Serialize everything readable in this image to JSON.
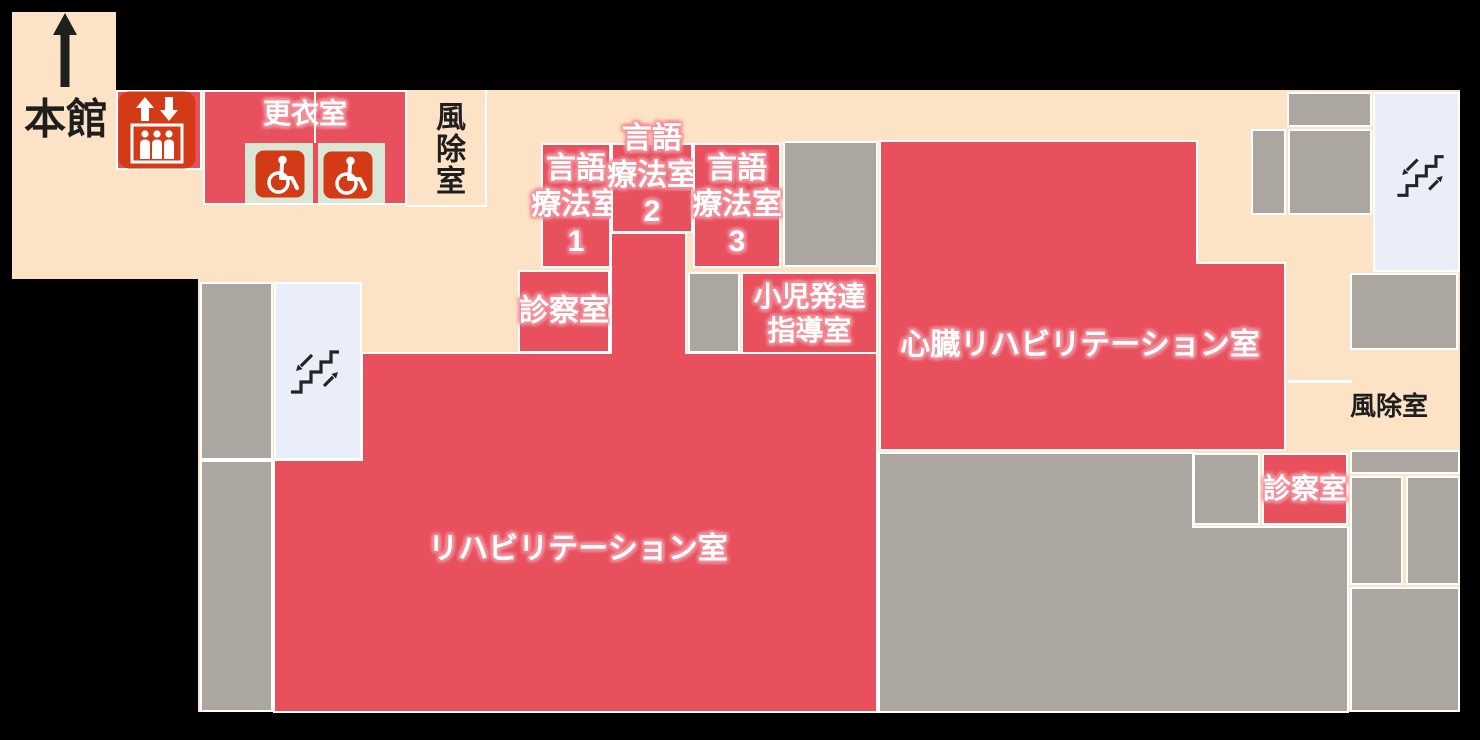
{
  "canvas": {
    "width": 1480,
    "height": 740,
    "background": "#000000"
  },
  "palette": {
    "floor_cream": "#FCE3C5",
    "room_red": "#E8505E",
    "room_gray": "#ABA69F",
    "stair_blue": "#E9EEF8",
    "pad_green": "#D9E7D4",
    "icon_red": "#D23B16",
    "wall_line": "#FFFFFF",
    "text_dark": "#1E1E1E",
    "text_light": "#FFFFFF",
    "label_halo": "#F2919C",
    "arrow_black": "#1F1F1F"
  },
  "floor": {
    "outline_points": "12,12 116,12 116,90 1460,90 1460,712 198,712 198,279 12,279"
  },
  "free_labels": [
    {
      "id": "main-building-label",
      "text": "本館",
      "cx": 66,
      "cy": 119,
      "size": 42,
      "color": "dark"
    },
    {
      "id": "vestibule-right-label",
      "text": "風除室",
      "cx": 1389,
      "cy": 407,
      "size": 26,
      "color": "dark"
    }
  ],
  "rooms": [
    {
      "id": "elevator-bay",
      "kind": "red",
      "x": 116,
      "y": 90,
      "w": 86,
      "h": 80
    },
    {
      "id": "changing-room",
      "kind": "red",
      "x": 203,
      "y": 90,
      "w": 204,
      "h": 115,
      "label": {
        "lines": [
          "更衣室"
        ],
        "size": 28,
        "color": "light",
        "valign": "top",
        "dy": 7
      }
    },
    {
      "id": "changing-pad-left",
      "kind": "green",
      "x": 245,
      "y": 143,
      "w": 68,
      "h": 60,
      "border": "none"
    },
    {
      "id": "changing-pad-right",
      "kind": "green",
      "x": 318,
      "y": 143,
      "w": 67,
      "h": 60,
      "border": "none"
    },
    {
      "id": "vestibule-top",
      "kind": "cream",
      "x": 407,
      "y": 90,
      "w": 80,
      "h": 117,
      "border": "rb",
      "label": {
        "lines": [
          "風除室"
        ],
        "size": 30,
        "color": "dark",
        "vertical": true
      }
    },
    {
      "id": "speech-therapy-room-1",
      "kind": "red",
      "x": 541,
      "y": 143,
      "w": 70,
      "h": 125,
      "label": {
        "lines": [
          "言語",
          "療法室",
          "1"
        ],
        "size": 30,
        "color": "light"
      }
    },
    {
      "id": "speech-therapy-room-2",
      "kind": "red",
      "x": 611,
      "y": 143,
      "w": 82,
      "h": 90,
      "label": {
        "lines": [
          "言語",
          "療法室",
          "2"
        ],
        "size": 30,
        "color": "light",
        "cy": 176
      }
    },
    {
      "id": "speech-therapy-room-3",
      "kind": "red",
      "x": 693,
      "y": 143,
      "w": 88,
      "h": 125,
      "label": {
        "lines": [
          "言語",
          "療法室",
          "3"
        ],
        "size": 30,
        "color": "light"
      }
    },
    {
      "id": "exam-room-left",
      "kind": "red",
      "x": 518,
      "y": 270,
      "w": 92,
      "h": 83,
      "label": {
        "lines": [
          "診察室"
        ],
        "size": 30,
        "color": "light"
      }
    },
    {
      "id": "pediatric-development-room",
      "kind": "red",
      "x": 741,
      "y": 272,
      "w": 137,
      "h": 83,
      "label": {
        "lines": [
          "小児発達",
          "指導室"
        ],
        "size": 28,
        "color": "light"
      }
    },
    {
      "id": "cardiac-rehabilitation-room",
      "kind": "red",
      "points": "880,141 1197,141 1197,263 1285,263 1285,450 880,450",
      "label": {
        "lines": [
          "心臓リハビリテーション室"
        ],
        "size": 30,
        "color": "light",
        "cx": 1080,
        "cy": 346
      }
    },
    {
      "id": "rehabilitation-room",
      "kind": "red",
      "points": "362,353 611,353 611,233 686,233 686,353 877,353 877,712 274,712 274,460 362,460",
      "label": {
        "lines": [
          "リハビリテーション室"
        ],
        "size": 30,
        "color": "light",
        "cx": 578,
        "cy": 550
      }
    },
    {
      "id": "exam-room-right",
      "kind": "red",
      "x": 1262,
      "y": 453,
      "w": 86,
      "h": 72,
      "label": {
        "lines": [
          "診察室"
        ],
        "size": 28,
        "color": "light"
      }
    },
    {
      "id": "stairwell-left",
      "kind": "blue",
      "x": 274,
      "y": 282,
      "w": 88,
      "h": 178
    },
    {
      "id": "stairwell-right",
      "kind": "blue",
      "x": 1373,
      "y": 92,
      "w": 87,
      "h": 180
    },
    {
      "id": "gray-room-left-upper",
      "kind": "gray",
      "x": 200,
      "y": 282,
      "w": 73,
      "h": 178
    },
    {
      "id": "gray-room-left-lower",
      "kind": "gray",
      "x": 200,
      "y": 460,
      "w": 73,
      "h": 252
    },
    {
      "id": "gray-room-center-upper",
      "kind": "gray",
      "x": 783,
      "y": 141,
      "w": 95,
      "h": 126
    },
    {
      "id": "gray-room-center-small",
      "kind": "gray",
      "x": 688,
      "y": 272,
      "w": 52,
      "h": 81
    },
    {
      "id": "gray-room-bottom-large",
      "kind": "gray",
      "points": "879,453 1193,453 1193,527 1348,527 1348,712 879,712"
    },
    {
      "id": "gray-room-next-to-exam",
      "kind": "gray",
      "x": 1193,
      "y": 453,
      "w": 67,
      "h": 72
    },
    {
      "id": "gray-room-topright-a",
      "kind": "gray",
      "x": 1287,
      "y": 92,
      "w": 85,
      "h": 35
    },
    {
      "id": "gray-room-topright-b",
      "kind": "gray",
      "x": 1251,
      "y": 129,
      "w": 35,
      "h": 86
    },
    {
      "id": "gray-room-topright-c",
      "kind": "gray",
      "x": 1288,
      "y": 129,
      "w": 84,
      "h": 86
    },
    {
      "id": "gray-room-right-mid",
      "kind": "gray",
      "x": 1350,
      "y": 273,
      "w": 108,
      "h": 77
    },
    {
      "id": "gray-room-right-band",
      "kind": "gray",
      "x": 1350,
      "y": 450,
      "w": 110,
      "h": 24
    },
    {
      "id": "gray-room-right-d",
      "kind": "gray",
      "x": 1350,
      "y": 476,
      "w": 53,
      "h": 109
    },
    {
      "id": "gray-room-right-e",
      "kind": "gray",
      "x": 1406,
      "y": 476,
      "w": 54,
      "h": 109
    },
    {
      "id": "gray-room-right-f",
      "kind": "gray",
      "x": 1350,
      "y": 587,
      "w": 110,
      "h": 125
    }
  ],
  "lines": [
    {
      "id": "changing-room-divider",
      "x": 314,
      "y": 92,
      "w": 2,
      "h": 51
    },
    {
      "id": "vestibule-right-top-line",
      "x": 1288,
      "y": 380,
      "w": 64,
      "h": 3
    }
  ],
  "icons": [
    {
      "id": "up-arrow-icon",
      "type": "up-arrow",
      "x": 53,
      "y": 13,
      "w": 24,
      "h": 74
    },
    {
      "id": "elevator-icon",
      "type": "elevator",
      "x": 118,
      "y": 91,
      "w": 78,
      "h": 78
    },
    {
      "id": "wheelchair-icon-left",
      "type": "wheelchair",
      "x": 255,
      "y": 150,
      "w": 50,
      "h": 48
    },
    {
      "id": "wheelchair-icon-right",
      "type": "wheelchair",
      "x": 323,
      "y": 151,
      "w": 50,
      "h": 48
    },
    {
      "id": "stairs-icon-left",
      "type": "stairs",
      "x": 287,
      "y": 342,
      "w": 56,
      "h": 58
    },
    {
      "id": "stairs-icon-right",
      "type": "stairs",
      "x": 1393,
      "y": 147,
      "w": 55,
      "h": 56
    }
  ]
}
